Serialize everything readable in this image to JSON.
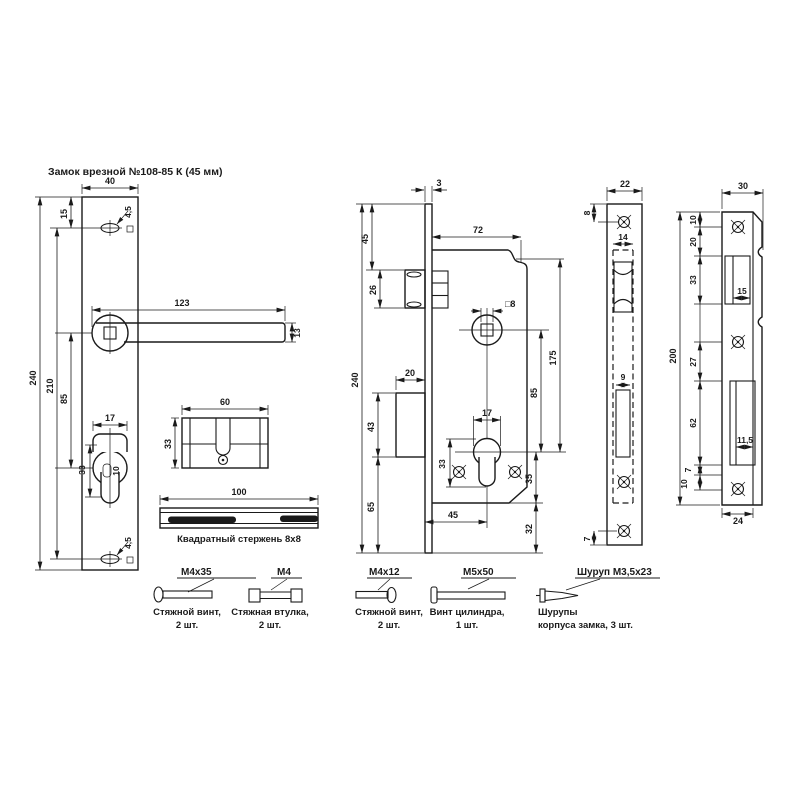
{
  "title": "Замок врезной №108-85 К (45 мм)",
  "plate_view": {
    "width": "40",
    "height": "240",
    "holes_span": "210",
    "handle_to_cyl": "85",
    "top_offset": "15",
    "screw_hole_top": "4,5",
    "screw_hole_bottom": "4,5",
    "handle_len": "123",
    "handle_w": "13",
    "cyl_w": "17",
    "cyl_h": "33",
    "cyl_d": "10"
  },
  "cylinder_view": {
    "length": "60",
    "height": "33"
  },
  "rod_view": {
    "length": "100",
    "caption": "Квадратный стержень 8x8"
  },
  "body_view": {
    "plate_t": "3",
    "depth": "72",
    "height": "240",
    "top_to_latch": "45",
    "latch_h": "26",
    "spindle": "□8",
    "bolt_throw": "20",
    "bolt_h": "43",
    "bottom": "65",
    "axes": "85",
    "height2": "175",
    "cyl_w": "17",
    "cyl_h": "33",
    "cyl_bottom": "35",
    "margin": "32",
    "backset": "45"
  },
  "faceplate_view": {
    "width": "22",
    "top_hole": "8",
    "slot_w": "14",
    "bolt_slot": "9",
    "bottom_hole": "7"
  },
  "strike_view": {
    "width": "30",
    "flat": "24",
    "height": "200",
    "latch_win": "15",
    "bolt_win": "11,5",
    "chain": [
      "10",
      "20",
      "33",
      "27",
      "62",
      "7",
      "10"
    ]
  },
  "hardware": [
    {
      "label": "M4x35",
      "line1": "Стяжной винт,",
      "line2": "2 шт."
    },
    {
      "label": "M4",
      "line1": "Стяжная втулка,",
      "line2": "2 шт."
    },
    {
      "label": "M4x12",
      "line1": "Стяжной винт,",
      "line2": "2 шт."
    },
    {
      "label": "M5x50",
      "line1": "Винт цилиндра,",
      "line2": "1 шт."
    },
    {
      "label": "Шуруп М3,5x23",
      "line1": "Шурупы",
      "line2": "корпуса замка, 3 шт."
    }
  ]
}
